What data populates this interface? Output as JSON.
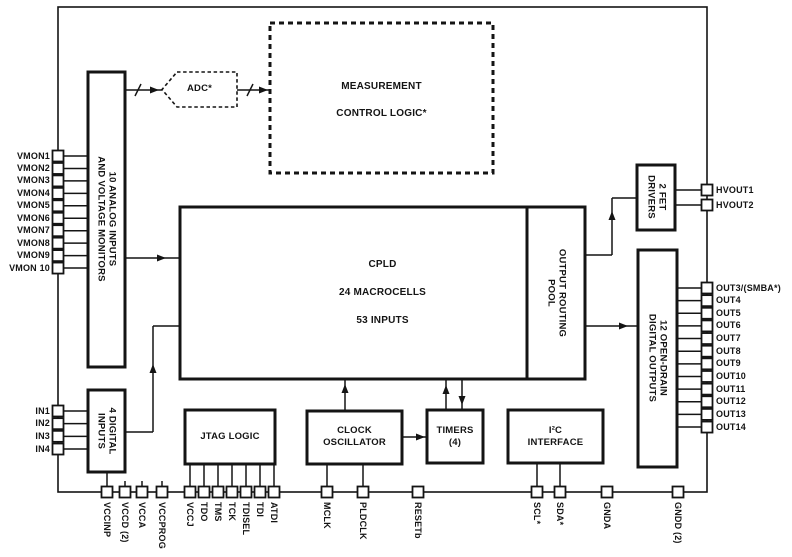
{
  "diagram": {
    "title": "CPLD supervisor block diagram",
    "colors": {
      "line": "#141414",
      "background": "#ffffff"
    },
    "blocks": {
      "analog_monitors": {
        "label": "10 ANALOG INPUTS\nAND VOLTAGE MONITORS"
      },
      "digital_inputs": {
        "label": "4 DIGITAL\nINPUTS"
      },
      "adc": {
        "label": "ADC*"
      },
      "measurement_control": {
        "label": "MEASUREMENT\nCONTROL LOGIC*"
      },
      "cpld": {
        "label": "CPLD\n24 MACROCELLS\n53 INPUTS"
      },
      "output_routing_pool": {
        "label": "OUTPUT ROUTING\nPOOL"
      },
      "fet_drivers": {
        "label": "2 FET\nDRIVERS"
      },
      "open_drain_outputs": {
        "label": "12 OPEN-DRAIN\nDIGITAL OUTPUTS"
      },
      "jtag": {
        "label": "JTAG LOGIC"
      },
      "clock_oscillator": {
        "label": "CLOCK\nOSCILLATOR"
      },
      "timers": {
        "label": "TIMERS\n(4)"
      },
      "i2c": {
        "label": "I²C\nINTERFACE"
      }
    },
    "pins": {
      "vmon": [
        "VMON1",
        "VMON2",
        "VMON3",
        "VMON4",
        "VMON5",
        "VMON6",
        "VMON7",
        "VMON8",
        "VMON9",
        "VMON 10"
      ],
      "digital_in": [
        "IN1",
        "IN2",
        "IN3",
        "IN4"
      ],
      "hvout": [
        "HVOUT1",
        "HVOUT2"
      ],
      "out": [
        "OUT3/(SMBA*)",
        "OUT4",
        "OUT5",
        "OUT6",
        "OUT7",
        "OUT8",
        "OUT9",
        "OUT10",
        "OUT11",
        "OUT12",
        "OUT13",
        "OUT14"
      ],
      "bottom": [
        "VCCINP",
        "VCCD (2)",
        "VCCA",
        "VCCPROG",
        "VCCJ",
        "TDO",
        "TMS",
        "TCK",
        "TDISEL",
        "TDI",
        "ATDI",
        "MCLK",
        "PLDCLK",
        "RESETb",
        "SCL*",
        "SDA*",
        "GNDA",
        "GNDD (2)"
      ]
    }
  }
}
